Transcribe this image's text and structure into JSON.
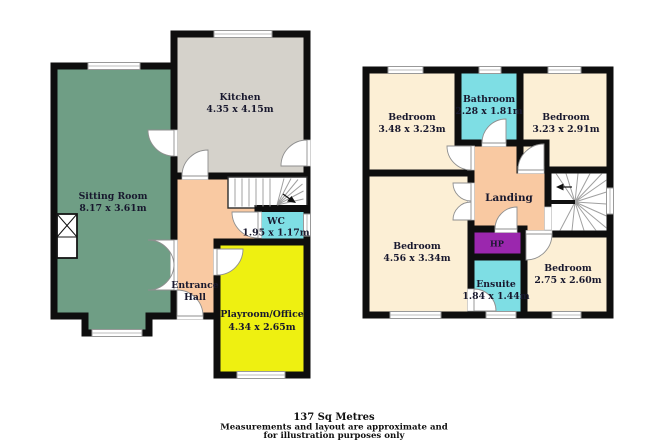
{
  "colors": {
    "wall": "#0e0e0e",
    "sitting_room": "#6f9e85",
    "kitchen": "#d5d2cb",
    "hall": "#f9c9a2",
    "wet_room": "#7edee4",
    "playroom": "#eef011",
    "bedroom": "#fcefd5",
    "hp": "#9b27ae",
    "stairs": "#ffffff"
  },
  "ground_floor": {
    "rooms": {
      "sitting_room": {
        "name": "Sitting Room",
        "dims": "8.17 x 3.61m"
      },
      "kitchen": {
        "name": "Kitchen",
        "dims": "4.35 x 4.15m"
      },
      "wc": {
        "name": "WC",
        "dims": "1.95 x 1.17m"
      },
      "entrance_hall": {
        "name_line1": "Entrance",
        "name_line2": "Hall"
      },
      "playroom": {
        "name": "Playroom/Office",
        "dims": "4.34 x 2.65m"
      }
    }
  },
  "first_floor": {
    "rooms": {
      "bedroom_front_left": {
        "name": "Bedroom",
        "dims": "3.48 x 3.23m"
      },
      "bathroom": {
        "name": "Bathroom",
        "dims": "2.28 x 1.81m"
      },
      "bedroom_front_right": {
        "name": "Bedroom",
        "dims": "3.23 x 2.91m"
      },
      "landing": {
        "name": "Landing"
      },
      "bedroom_back_left": {
        "name": "Bedroom",
        "dims": "4.56 x 3.34m"
      },
      "hp": {
        "name": "HP"
      },
      "ensuite": {
        "name": "Ensuite",
        "dims": "1.84 x 1.44m"
      },
      "bedroom_back_right": {
        "name": "Bedroom",
        "dims": "2.75 x 2.60m"
      }
    }
  },
  "footer": {
    "area": "137 Sq Metres",
    "disclaimer_line1": "Measurements and layout are approximate and",
    "disclaimer_line2": "for illustration purposes only"
  }
}
